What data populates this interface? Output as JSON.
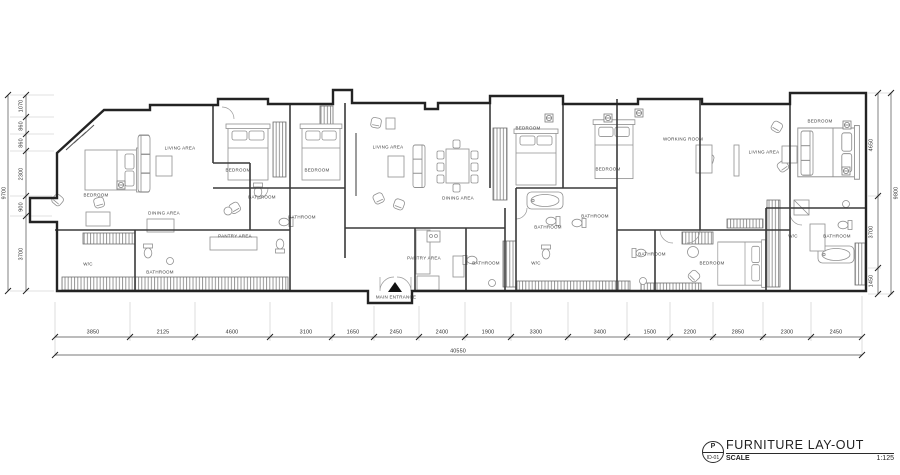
{
  "title_block": {
    "code_top": "P",
    "code_bottom": "ID-01",
    "title": "FURNITURE LAY-OUT",
    "scale_label": "SCALE",
    "scale_value": "1:125"
  },
  "colors": {
    "wall": "#2b2b2b",
    "furniture": "#8f8f8f",
    "dimension": "#555555",
    "paper": "#ffffff"
  },
  "plan": {
    "room_labels": [
      {
        "text": "BEDROOM",
        "x": 96,
        "y": 195
      },
      {
        "text": "LIVING AREA",
        "x": 180,
        "y": 148
      },
      {
        "text": "DINING AREA",
        "x": 164,
        "y": 213
      },
      {
        "text": "PANTRY AREA",
        "x": 235,
        "y": 236
      },
      {
        "text": "W/C",
        "x": 88,
        "y": 264
      },
      {
        "text": "BATHROOM",
        "x": 160,
        "y": 272
      },
      {
        "text": "BEDROOM",
        "x": 238,
        "y": 170
      },
      {
        "text": "BEDROOM",
        "x": 317,
        "y": 170
      },
      {
        "text": "BATHROOM",
        "x": 262,
        "y": 197
      },
      {
        "text": "BATHROOM",
        "x": 302,
        "y": 217
      },
      {
        "text": "LIVING AREA",
        "x": 388,
        "y": 147
      },
      {
        "text": "DINING AREA",
        "x": 458,
        "y": 198
      },
      {
        "text": "BEDROOM",
        "x": 528,
        "y": 128
      },
      {
        "text": "BEDROOM",
        "x": 608,
        "y": 169
      },
      {
        "text": "BATHROOM",
        "x": 548,
        "y": 227
      },
      {
        "text": "BATHROOM",
        "x": 595,
        "y": 216
      },
      {
        "text": "PANTRY AREA",
        "x": 424,
        "y": 258
      },
      {
        "text": "BATHROOM",
        "x": 486,
        "y": 263
      },
      {
        "text": "W/C",
        "x": 536,
        "y": 263
      },
      {
        "text": "MAIN ENTRANCE",
        "x": 396,
        "y": 297
      },
      {
        "text": "WORKING ROOM",
        "x": 683,
        "y": 139
      },
      {
        "text": "LIVING AREA",
        "x": 764,
        "y": 152
      },
      {
        "text": "BEDROOM",
        "x": 820,
        "y": 121
      },
      {
        "text": "BATHROOM",
        "x": 652,
        "y": 254
      },
      {
        "text": "BEDROOM",
        "x": 712,
        "y": 263
      },
      {
        "text": "W/C",
        "x": 793,
        "y": 236
      },
      {
        "text": "BATHROOM",
        "x": 837,
        "y": 236
      }
    ],
    "dimension_labels": [
      {
        "text": "3850",
        "x": 93,
        "y": 332
      },
      {
        "text": "2125",
        "x": 163,
        "y": 332
      },
      {
        "text": "4600",
        "x": 232,
        "y": 332
      },
      {
        "text": "3100",
        "x": 306,
        "y": 332
      },
      {
        "text": "1650",
        "x": 353,
        "y": 332
      },
      {
        "text": "2450",
        "x": 396,
        "y": 332
      },
      {
        "text": "2400",
        "x": 442,
        "y": 332
      },
      {
        "text": "1900",
        "x": 488,
        "y": 332
      },
      {
        "text": "3300",
        "x": 536,
        "y": 332
      },
      {
        "text": "3400",
        "x": 600,
        "y": 332
      },
      {
        "text": "1500",
        "x": 650,
        "y": 332
      },
      {
        "text": "2200",
        "x": 690,
        "y": 332
      },
      {
        "text": "2850",
        "x": 738,
        "y": 332
      },
      {
        "text": "2300",
        "x": 787,
        "y": 332
      },
      {
        "text": "2450",
        "x": 836,
        "y": 332
      },
      {
        "text": "40550",
        "x": 458,
        "y": 351
      },
      {
        "text": "1070",
        "x": 21,
        "y": 106,
        "rot": -90
      },
      {
        "text": "860",
        "x": 21,
        "y": 126,
        "rot": -90
      },
      {
        "text": "860",
        "x": 21,
        "y": 143,
        "rot": -90
      },
      {
        "text": "2300",
        "x": 21,
        "y": 174,
        "rot": -90
      },
      {
        "text": "900",
        "x": 21,
        "y": 207,
        "rot": -90
      },
      {
        "text": "3700",
        "x": 21,
        "y": 254,
        "rot": -90
      },
      {
        "text": "9700",
        "x": 4,
        "y": 193,
        "rot": -90
      },
      {
        "text": "4650",
        "x": 871,
        "y": 145,
        "rot": -90
      },
      {
        "text": "3700",
        "x": 871,
        "y": 232,
        "rot": -90
      },
      {
        "text": "1450",
        "x": 871,
        "y": 281,
        "rot": -90
      },
      {
        "text": "9800",
        "x": 896,
        "y": 193,
        "rot": -90
      }
    ]
  }
}
